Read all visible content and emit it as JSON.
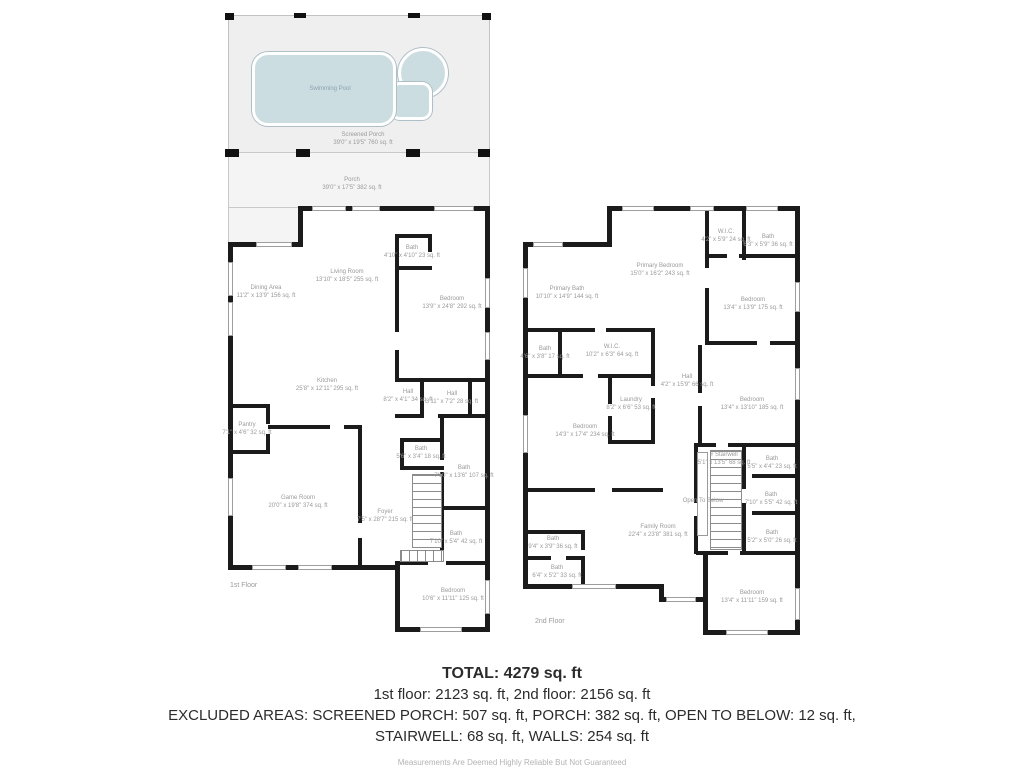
{
  "outdoor": {
    "pool_label": "Swimming Pool",
    "screened_porch": {
      "name": "Screened Porch",
      "dims": "39'0\" x 19'5\" 760 sq. ft"
    },
    "porch": {
      "name": "Porch",
      "dims": "39'0\" x 17'5\" 382 sq. ft"
    }
  },
  "floor1": {
    "caption": "1st Floor",
    "rooms": [
      {
        "name": "Dining Area",
        "dims": "11'2\" x 13'9\" 156 sq. ft"
      },
      {
        "name": "Living Room",
        "dims": "13'10\" x 18'5\" 255 sq. ft"
      },
      {
        "name": "Bath",
        "dims": "4'10\" x 4'10\" 23 sq. ft"
      },
      {
        "name": "Bedroom",
        "dims": "13'9\" x 24'8\" 292 sq. ft"
      },
      {
        "name": "Kitchen",
        "dims": "25'8\" x 12'11\" 295 sq. ft"
      },
      {
        "name": "Pantry",
        "dims": "7'1\" x 4'6\" 32 sq. ft"
      },
      {
        "name": "Hall",
        "dims": "8'2\" x 4'1\" 34 sq. ft"
      },
      {
        "name": "Hall",
        "dims": "3'11\" x 7'2\" 28 sq. ft"
      },
      {
        "name": "Bath",
        "dims": "5'6\" x 3'4\" 18 sq. ft"
      },
      {
        "name": "Bath",
        "dims": "7'10\" x 13'6\" 107 sq. ft"
      },
      {
        "name": "Foyer",
        "dims": "7'5\" x 28'7\" 215 sq. ft"
      },
      {
        "name": "Bath",
        "dims": "7'10\" x 5'4\" 42 sq. ft"
      },
      {
        "name": "Game Room",
        "dims": "20'0\" x 19'8\" 374 sq. ft"
      },
      {
        "name": "Bedroom",
        "dims": "10'6\" x 11'11\" 125 sq. ft"
      }
    ]
  },
  "floor2": {
    "caption": "2nd Floor",
    "rooms": [
      {
        "name": "Primary Bedroom",
        "dims": "15'0\" x 16'2\" 243 sq. ft"
      },
      {
        "name": "W.I.C.",
        "dims": "4'2\" x 5'9\" 24 sq. ft"
      },
      {
        "name": "Bath",
        "dims": "6'3\" x 5'9\" 36 sq. ft"
      },
      {
        "name": "Primary Bath",
        "dims": "10'10\" x 14'9\" 144 sq. ft"
      },
      {
        "name": "Bedroom",
        "dims": "13'4\" x 13'9\" 175 sq. ft"
      },
      {
        "name": "Bath",
        "dims": "4'6\" x 3'8\" 17 sq. ft"
      },
      {
        "name": "W.I.C.",
        "dims": "10'2\" x 6'3\" 64 sq. ft"
      },
      {
        "name": "Hall",
        "dims": "4'2\" x 15'9\" 66 sq. ft"
      },
      {
        "name": "Laundry",
        "dims": "8'2\" x 6'6\" 53 sq. ft"
      },
      {
        "name": "Bedroom",
        "dims": "14'3\" x 17'4\" 234 sq. ft"
      },
      {
        "name": "Bedroom",
        "dims": "13'4\" x 13'10\" 185 sq. ft"
      },
      {
        "name": "Stairwell",
        "dims": "5'1\" x 13'5\" 68 sq. ft"
      },
      {
        "name": "Open To Below",
        "dims": ""
      },
      {
        "name": "Bath",
        "dims": "5'5\" x 4'4\" 23 sq. ft"
      },
      {
        "name": "Bath",
        "dims": "7'10\" x 5'5\" 42 sq. ft"
      },
      {
        "name": "Bath",
        "dims": "5'2\" x 5'0\" 26 sq. ft"
      },
      {
        "name": "Family Room",
        "dims": "22'4\" x 23'8\" 381 sq. ft"
      },
      {
        "name": "Bath",
        "dims": "9'4\" x 3'9\" 36 sq. ft"
      },
      {
        "name": "Bath",
        "dims": "6'4\" x 5'2\" 33 sq. ft"
      },
      {
        "name": "Bedroom",
        "dims": "13'4\" x 11'11\" 159 sq. ft"
      }
    ]
  },
  "icons": {
    "up_arrow": "↑"
  },
  "summary": {
    "total": "TOTAL: 4279 sq. ft",
    "floors": "1st floor: 2123 sq. ft, 2nd floor: 2156 sq. ft",
    "excluded1": "EXCLUDED AREAS: SCREENED PORCH: 507 sq. ft, PORCH: 382 sq. ft, OPEN TO BELOW: 12 sq. ft,",
    "excluded2": "STAIRWELL: 68 sq. ft, WALLS: 254 sq. ft",
    "disclaimer": "Measurements Are Deemed Highly Reliable But Not Guaranteed"
  },
  "colors": {
    "pool": "#ccdde2",
    "wall": "#1b1b1b",
    "porch": "#efefef",
    "label": "#9a9a9a"
  }
}
